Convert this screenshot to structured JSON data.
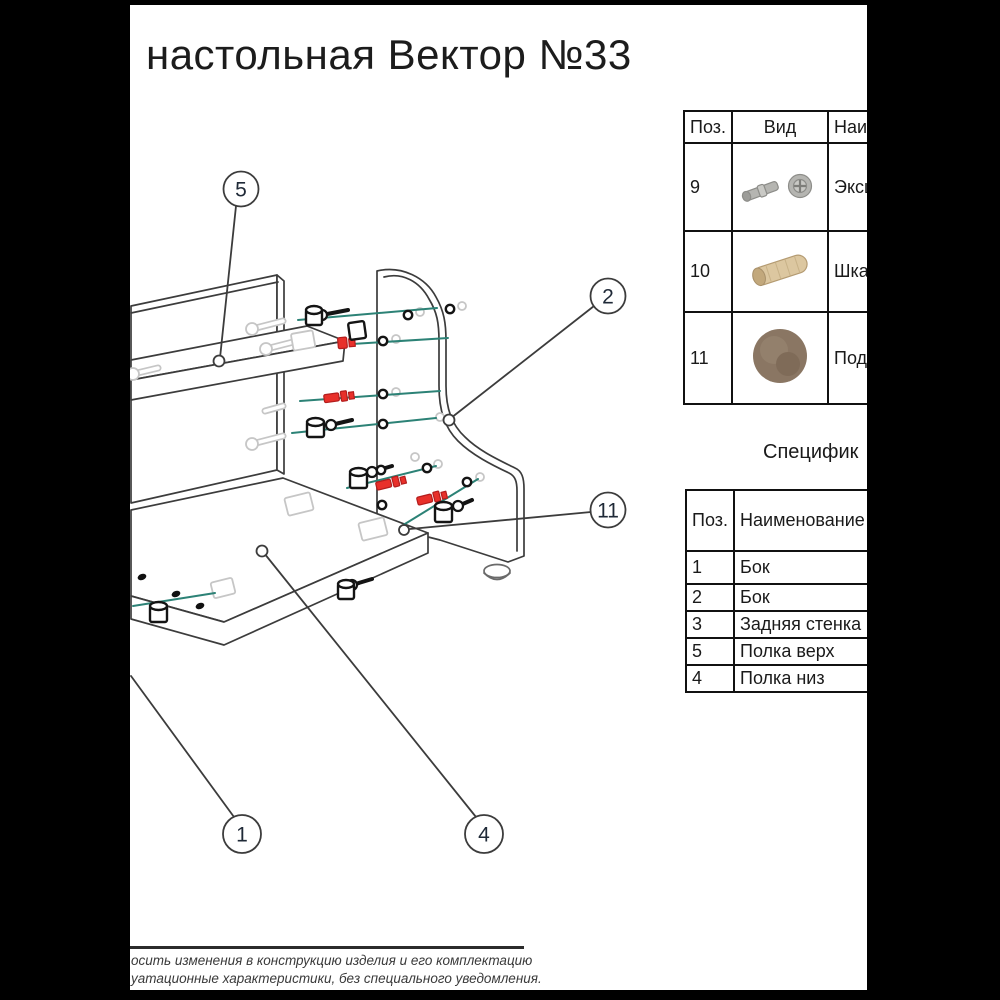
{
  "title": "настольная Вектор №33",
  "parts_table": {
    "headers": [
      "Поз.",
      "Вид",
      "Наим"
    ],
    "rows": [
      {
        "pos": "9",
        "view_icon": "eccentric-bolt-and-cam",
        "name": "Эксц"
      },
      {
        "pos": "10",
        "view_icon": "wooden-dowel",
        "name": "Шкан"
      },
      {
        "pos": "11",
        "view_icon": "felt-pad",
        "name": "Подп"
      }
    ]
  },
  "spec": {
    "heading": "Специфик",
    "headers": [
      "Поз.",
      "Наименование"
    ],
    "rows": [
      [
        "1",
        "Бок"
      ],
      [
        "2",
        "Бок"
      ],
      [
        "3",
        "Задняя стенка"
      ],
      [
        "5",
        "Полка верх"
      ],
      [
        "4",
        "Полка низ"
      ]
    ]
  },
  "callouts": [
    "5",
    "2",
    "11",
    "1",
    "4"
  ],
  "footer": {
    "line1": "осить изменения в конструкцию изделия и его комплектацию",
    "line2": "уатационные характеристики, без специального уведомления."
  },
  "colors": {
    "accent_red": "#e8302a",
    "dowel_teal": "#2c8276",
    "phantom_gray": "#c6c6c6",
    "line_dark": "#3c3c3c",
    "wood": "#dcc7a0",
    "pad_brown": "#8a7663",
    "metal": "#b5b5b1"
  }
}
